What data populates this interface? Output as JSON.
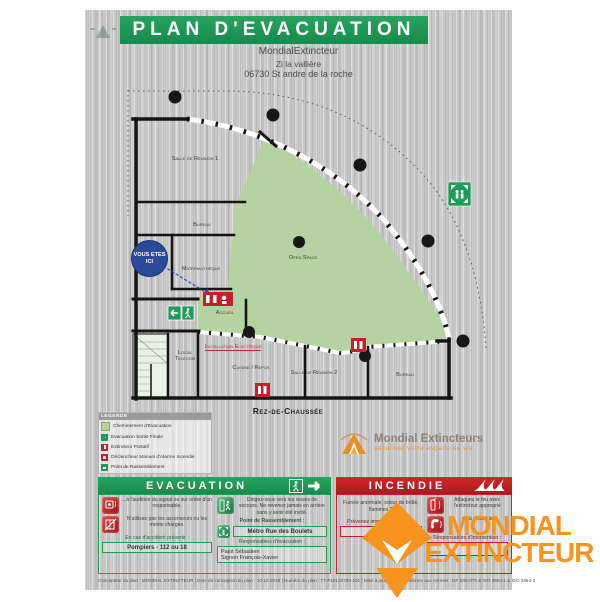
{
  "poster": {
    "title": "PLAN D'EVACUATION",
    "company": "MondialExtincteur",
    "address_line1": "Zi la vallière",
    "address_line2": "06730 St andre de la roche",
    "floor_label": "Rez-de-Chaussée",
    "footer": "Concepteur du plan : MONDIAL EXTINCTEUR   |   Date de conception du plan : 10-12-2019   |   Numéro du plan : TT-P16123700-101   |   Mise à jour N° : 1   |   Conforme aux normes : NF X08-070 & ISO 3864-1 & ISO 3864-3"
  },
  "plan": {
    "you_are_here": "VOUS ETES ICI",
    "rooms": {
      "salle_reunion_1": "Salle de Réunion 1",
      "bureau_1": "Bureau",
      "materiautheque": "Matériauthèque",
      "accueil": "Accueil",
      "local_telecom": "Local Telecom",
      "installation_electrique": "Installation Electrique",
      "cuisine_repos": "Cuisine / Repos",
      "salle_reunion_2": "Salle de Réunion 2",
      "bureau_2": "Bureau",
      "open_space": "Open Space"
    }
  },
  "legend": {
    "title": "LEGENDE",
    "items": [
      "Cheminement d'Evacuation",
      "Evacuation Sortie Finale",
      "Extincteur Portatif",
      "Déclencheur Manuel d'Alarme Incendie",
      "Point de Rassemblement"
    ]
  },
  "brand": {
    "name": "Mondial Extincteurs",
    "tagline": "sécuriser votre espace de vie"
  },
  "evacuation": {
    "title": "EVACUATION",
    "item_signal": "...à l'audition du signal ou sur ordre d'un responsable.",
    "item_elevator": "N'utilisez pas les ascenseurs ou les monte charges.",
    "item_exits": "Dirigez-vous vers les issues de secours. Ne revenez jamais en arrière sans y avoir été invité.",
    "assembly_label": "Point de Rassemblement :",
    "assembly_value": "Métro Rue des Boulets",
    "accident_label": "En cas d'accident prévenir :",
    "accident_value": "Pompiers - 112 ou 18",
    "responsables_label": "Responsables d'évacuation :",
    "responsable_1": "Pajot Sébastien",
    "responsable_2": "Signon François-Xavier"
  },
  "incendie": {
    "title": "INCENDIE",
    "alert_text": "Fumée anormale, odeur de brûlé, flammes ?",
    "prevenez_label": "Prévenez immédiatement le :",
    "number_value": "18 ou",
    "attack_text": "Attaquez le feu avec l'extincteur approprié",
    "default_text": "ou à défaut le",
    "responsables_label": "Responsables d'intervention :"
  },
  "watermark": {
    "line1": "MONDIAL",
    "line2": "EXTINCTEUR"
  },
  "colors": {
    "green": "#1E9C57",
    "red": "#C32026",
    "path_green": "#B4D3A0",
    "orange": "#F7941E",
    "blue": "#2B4A9A"
  }
}
